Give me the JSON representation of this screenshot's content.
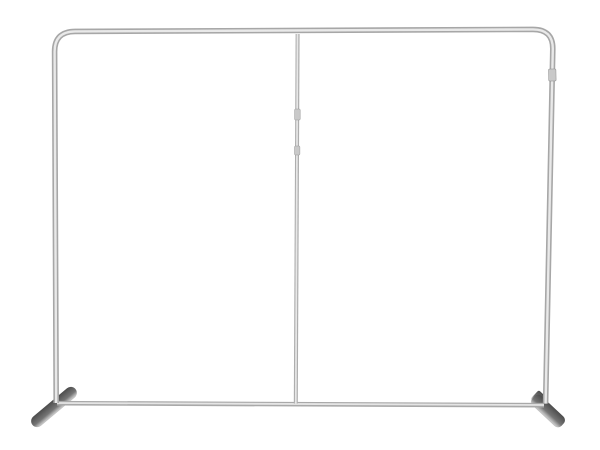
{
  "meta": {
    "description": "Product photo of an empty silver aluminum tube backdrop display frame with rounded top corners, a thin center support pole, a bottom crossbar and two dark angled stabilizer feet, on a plain white background",
    "background_color": "#ffffff"
  },
  "colors": {
    "tube_base": "#a7a7a7",
    "tube_highlight": "#e9e9e9",
    "pole_base": "#aeaeae",
    "pole_highlight": "#e7e7e7",
    "bar_base": "#a9a9a9",
    "bar_highlight": "#e4e4e4",
    "joint_fill": "#c9c9c9",
    "joint_edge": "#999999",
    "foot_dark": "#4c4c4c",
    "foot_mid": "#757575",
    "foot_light": "#c2c2c2"
  }
}
